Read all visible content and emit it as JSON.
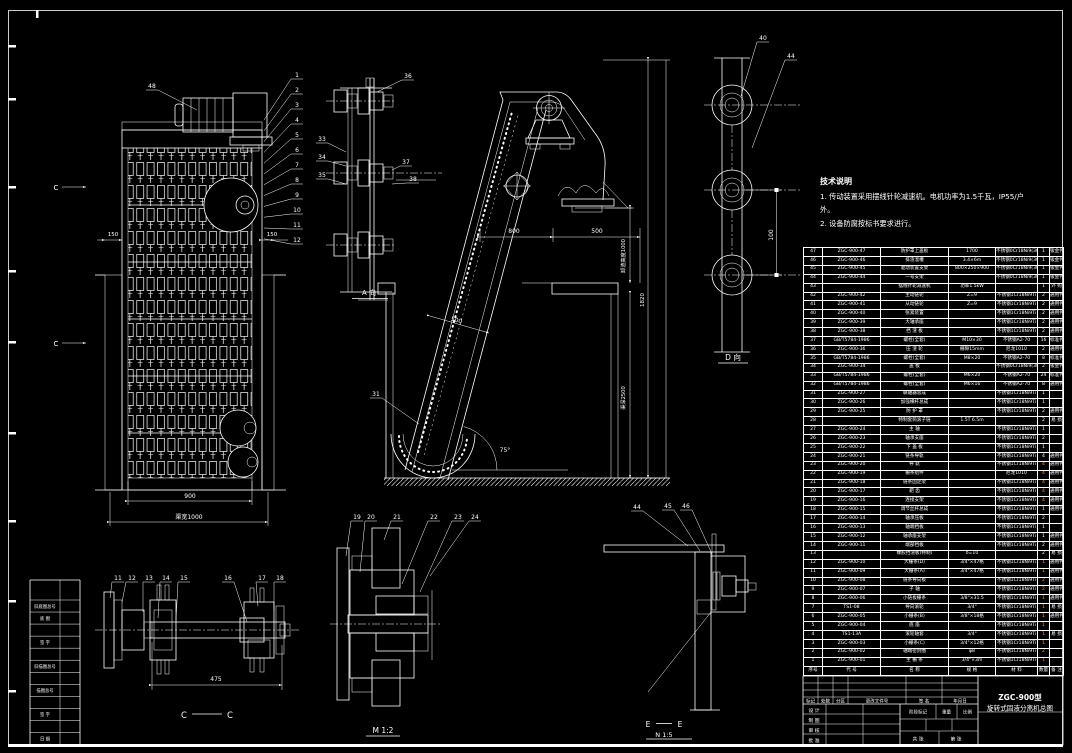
{
  "drawing": {
    "bg": "#000000",
    "line": "#ffffff",
    "accent": "#e8a33d"
  },
  "tech_notes": {
    "title": "技术说明",
    "lines": [
      "1. 传动装置采用摆线针轮减速机。电机功率为1.5千瓦，IP55/户",
      "外。",
      "2. 设备防腐按标书要求进行。"
    ]
  },
  "views": {
    "front": {
      "dim_left": "150",
      "dim_right": "150",
      "dim_width": "900",
      "dim_channel": "渠宽1000",
      "section_letter": "C",
      "balloons": [
        "48",
        "1",
        "2",
        "3",
        "4",
        "5",
        "6",
        "7",
        "8",
        "9",
        "10",
        "11",
        "12"
      ]
    },
    "chain_side": {
      "label": "A 向",
      "balloons": [
        "33",
        "34",
        "35",
        "36",
        "37",
        "38"
      ]
    },
    "main": {
      "dim_800": "800",
      "dim_500": "500",
      "dim_500_diag": "500",
      "angle": "75°",
      "discharge_height": "卸渣高度1000",
      "overall_height": "1820",
      "channel_depth": "渠深2500",
      "balloons": [
        "31"
      ]
    },
    "d_view": {
      "label": "D 向",
      "dim_100": "100",
      "balloons": [
        "40",
        "44"
      ]
    },
    "cc_section": {
      "letter": "C",
      "dim_475": "475",
      "balloons": [
        "11",
        "12",
        "13",
        "14",
        "15",
        "16",
        "17",
        "18"
      ]
    },
    "m_detail": {
      "label": "M 1:2",
      "balloons": [
        "19",
        "20",
        "21",
        "22",
        "23",
        "24"
      ]
    },
    "e_detail": {
      "letter": "E",
      "scale_label": "N 1:5",
      "balloons": [
        "44",
        "45",
        "46"
      ]
    }
  },
  "parts_table": {
    "headers": [
      "序号",
      "代 号",
      "名 称",
      "规 格",
      "材 料",
      "数量",
      "备 注"
    ],
    "rows": [
      [
        "47",
        "ZGC-900-47",
        "防护罩上盖板",
        "1700",
        "不锈钢0Cr18Ni9(304)",
        "1",
        "钣金件",
        false
      ],
      [
        "46",
        "ZGC-900-46",
        "排渣溜槽",
        "3.4×6m",
        "不锈钢0Cr18Ni9(304)",
        "1",
        "钣金件",
        false
      ],
      [
        "45",
        "ZGC-900-45",
        "驱动装置支架",
        "800×250×900",
        "不锈钢0Cr18Ni9(304)",
        "1",
        "钣金件",
        false
      ],
      [
        "44",
        "ZGC-900-44",
        "一号支架",
        "",
        "不锈钢0Cr18Ni9(304)",
        "1",
        "钣金件",
        false
      ],
      [
        "43",
        "",
        "摆线针轮减速机",
        "功率1.5kW",
        "",
        "1",
        "外 购",
        false
      ],
      [
        "42",
        "ZGC-900-42",
        "主动链轮",
        "Z=9",
        "不锈钢1Cr18Ni9Ti",
        "2",
        "通用件",
        false
      ],
      [
        "41",
        "ZGC-900-41",
        "从动链轮",
        "Z=9",
        "不锈钢1Cr18Ni9Ti",
        "2",
        "通用件",
        false
      ],
      [
        "40",
        "ZGC-900-40",
        "张紧装置",
        "",
        "不锈钢1Cr18Ni9Ti",
        "2",
        "通用件",
        false
      ],
      [
        "39",
        "ZGC-900-39",
        "大轴承座",
        "",
        "不锈钢1Cr18Ni9Ti",
        "2",
        "通用件",
        false
      ],
      [
        "38",
        "ZGC-900-38",
        "挡 渣 板",
        "",
        "不锈钢1Cr18Ni9Ti",
        "2",
        "通用件",
        false
      ],
      [
        "37",
        "GB/T5784-1986",
        "螺栓(全套)",
        "M10×30",
        "不锈钢A2-70",
        "16",
        "标准件",
        false
      ],
      [
        "36",
        "ZGC-900-36",
        "压 渣 轮",
        "栅隙15mm",
        "尼龙1010",
        "2",
        "通用件",
        false
      ],
      [
        "35",
        "GB/T5784-1986",
        "螺栓(全套)",
        "M8×20",
        "不锈钢A2-70",
        "8",
        "标准件",
        false
      ],
      [
        "34",
        "ZGC-900-34",
        "盖  板",
        "",
        "不锈钢0Cr18Ni9(304)",
        "2",
        "钣金件",
        false
      ],
      [
        "33",
        "GB/T5784-1986",
        "螺栓(全套)",
        "M6×20",
        "不锈钢A2-70",
        "24",
        "标准件",
        false
      ],
      [
        "32",
        "GB/T5784-1986",
        "螺栓(全套)",
        "M6×16",
        "不锈钢A2-70",
        "8",
        "通用件",
        false
      ],
      [
        "31",
        "ZGC-900-27",
        "联轴器总成",
        "",
        "不锈钢1Cr18Ni9Ti",
        "1",
        "",
        false
      ],
      [
        "30",
        "ZGC-900-26",
        "加强横杆总成",
        "",
        "不锈钢1Cr18Ni9Ti",
        "1",
        "",
        false
      ],
      [
        "29",
        "ZGC-900-25",
        "防 护 罩",
        "",
        "不锈钢1Cr18Ni9Ti",
        "2",
        "通用件",
        false
      ],
      [
        "28",
        "",
        "特制套筒滚子链",
        "1.5T 6.5m",
        "",
        "2",
        "易 损",
        false
      ],
      [
        "27",
        "ZGC-900-24",
        "主  轴",
        "",
        "不锈钢1Cr18Ni9Ti",
        "1",
        "",
        false
      ],
      [
        "26",
        "ZGC-900-23",
        "轴承支座",
        "",
        "不锈钢1Cr18Ni9Ti",
        "2",
        "",
        false
      ],
      [
        "25",
        "ZGC-900-22",
        "下 盖 板",
        "",
        "不锈钢1Cr18Ni9Ti",
        "1",
        "",
        false
      ],
      [
        "24",
        "ZGC-900-21",
        "链条导轨",
        "",
        "不锈钢1Cr18Ni9Ti",
        "4",
        "通用件",
        false
      ],
      [
        "23",
        "ZGC-900-20",
        "导  轨",
        "",
        "不锈钢1Cr18Ni9Ti",
        "4",
        "通用件",
        true
      ],
      [
        "22",
        "ZGC-900-19",
        "栅条组件",
        "",
        "尼龙1010",
        "4",
        "通用件",
        true
      ],
      [
        "21",
        "ZGC-900-18",
        "链条固定架",
        "",
        "不锈钢1Cr18Ni9Ti",
        "4",
        "通用件",
        true
      ],
      [
        "20",
        "ZGC-900-17",
        "耙  齿",
        "",
        "不锈钢1Cr18Ni9Ti",
        "4",
        "通用件",
        true
      ],
      [
        "19",
        "ZGC-900-16",
        "连接支架",
        "",
        "不锈钢1Cr18Ni9Ti",
        "4",
        "通用件",
        true
      ],
      [
        "18",
        "ZGC-900-15",
        "调节丝杆总成",
        "",
        "不锈钢1Cr18Ni9Ti",
        "1",
        "通用件",
        false
      ],
      [
        "17",
        "ZGC-900-14",
        "轴承压板",
        "",
        "不锈钢1Cr18Ni9Ti",
        "2",
        "",
        false
      ],
      [
        "16",
        "ZGC-900-13",
        "轴端挡板",
        "",
        "不锈钢1Cr18Ni9Ti",
        "1",
        "",
        false
      ],
      [
        "15",
        "ZGC-900-12",
        "轴承座支架",
        "",
        "不锈钢1Cr18Ni9Ti",
        "1",
        "通用件",
        false
      ],
      [
        "14",
        "ZGC-900-11",
        "端部挡板",
        "",
        "不锈钢1Cr18Ni9Ti",
        "2",
        "通用件",
        false
      ],
      [
        "13",
        "",
        "橡胶挡渣板(特制)",
        "δ=10",
        "",
        "2",
        "易 损",
        false
      ],
      [
        "12",
        "ZGC-900-10",
        "大栅条(D)",
        "3/4\"×47格",
        "不锈钢1Cr18Ni9Ti",
        "1",
        "通用件",
        true
      ],
      [
        "11",
        "ZGC-900-09",
        "大栅条(A)",
        "3/4\"×47格",
        "不锈钢1Cr18Ni9Ti",
        "1",
        "通用件",
        true
      ],
      [
        "10",
        "ZGC-900-08",
        "链条导向板",
        "",
        "不锈钢1Cr18Ni9Ti",
        "2",
        "通用件",
        true
      ],
      [
        "9",
        "ZGC-900-07",
        "子  轴",
        "",
        "不锈钢1Cr18Ni9Ti",
        "2",
        "通用件",
        true
      ],
      [
        "8",
        "ZGC-900-06",
        "小链板栅条",
        "3/8\"×31.5",
        "不锈钢1Cr18Ni9Ti",
        "1",
        "通用件",
        true
      ],
      [
        "7",
        "TS1-08",
        "导向滚轮",
        "3/4\"",
        "不锈钢1Cr18Ni9Ti",
        "1",
        "易 损",
        true
      ],
      [
        "6",
        "ZGC-900-05",
        "小栅条(B)",
        "3/8\"×18格",
        "不锈钢1Cr18Ni9Ti",
        "1",
        "通用件",
        true
      ],
      [
        "5",
        "ZGC-900-04",
        "底  座",
        "",
        "不锈钢1Cr18Ni9Ti",
        "1",
        "",
        true
      ],
      [
        "4",
        "TS1-13A",
        "滚轮轴套",
        "3/4\"",
        "不锈钢1Cr18Ni9Ti",
        "1",
        "易 损",
        true
      ],
      [
        "3",
        "ZGC-900-03",
        "小栅条(C)",
        "3/4\"×12格",
        "不锈钢1Cr18Ni9Ti",
        "1",
        "",
        true
      ],
      [
        "2",
        "ZGC-900-02",
        "轴端密封圈",
        "φ8",
        "不锈钢1Cr18Ni9Ti",
        "2",
        "",
        true
      ],
      [
        "1",
        "ZGC-900-01",
        "主 栅 条",
        "3/4\"×3m",
        "不锈钢1Cr18Ni9Ti",
        "1",
        "",
        true
      ]
    ]
  },
  "title_block": {
    "model": "ZGC-900型",
    "title": "旋转式固液分离机总图",
    "labels": {
      "mark": "标记",
      "count": "处数",
      "zone": "分区",
      "doc": "更改文件号",
      "sign": "签 名",
      "date": "年月日",
      "design": "设 计",
      "draft": "制 图",
      "check": "审 核",
      "approve": "批 准",
      "stage": "阶段标记",
      "weight": "重量",
      "scale": "比例",
      "sheets": "共  张",
      "sheet": "第  张"
    }
  },
  "left_strip": {
    "rows": [
      "",
      "旧底图总号",
      "底 图",
      "",
      "签 字",
      "",
      "旧描图总号",
      "",
      "描图总号",
      "",
      "签 字",
      "",
      "日 期"
    ]
  }
}
